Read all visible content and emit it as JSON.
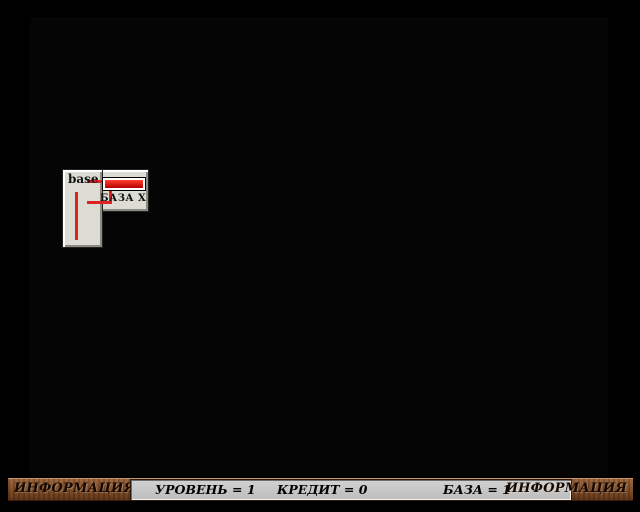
{
  "map": {
    "left": 30,
    "top": 17,
    "cols": 15,
    "rows": [
      "RRRRRRRRRRRRRRR",
      "WSSSWTTWSWTTTWF",
      "PSASSSSSSSSSSPH",
      "PSSSSBBBBBSWSSH",
      "SSSSQDDDDD2WSUH",
      "SSSSQDAAADSSSUH",
      "DGGGDDAAADSWSUH",
      "SDGDSDDDDCSWSUH",
      "SSDSSBBBBBCSSUH",
      "2DGDSSDSDSSWSUH",
      "DGGGDDSSSDSWCUH",
      "GGGGGDSZSDSWSCH"
    ],
    "width": 578,
    "height": 460,
    "legend": {
      "R": "railroad-track",
      "S": "stone-tile",
      "W": "window-wall-tile",
      "T": "window-top-tile",
      "P": "pillar-tile",
      "Q": "pillar-tile",
      "2": "window-pair-tile",
      "A": "water-tile",
      "B": "armor-plate-tile",
      "D": "red-block-tile",
      "G": "green-plate-tile",
      "C": "grate-tile",
      "U": "rubble-tile",
      "F": "ruined-red-tile",
      "H": "red-wall-tile",
      "Z": "gate-tile"
    }
  },
  "sprites": [
    {
      "type": "tank-green",
      "dir": "right",
      "x": 196,
      "y": 18
    },
    {
      "type": "tank-red",
      "dir": "right",
      "x": 378,
      "y": 15
    },
    {
      "type": "bullets-black",
      "x": 420,
      "y": 27
    },
    {
      "type": "shell-yellow",
      "x": 561,
      "y": 22
    },
    {
      "type": "tank-green",
      "dir": "right",
      "x": 110,
      "y": 58
    },
    {
      "type": "bullets-orange",
      "x": 162,
      "y": 63
    },
    {
      "type": "tank-green",
      "dir": "left",
      "x": 288,
      "y": 134
    },
    {
      "type": "bullets-orange",
      "x": 266,
      "y": 141
    },
    {
      "type": "tank-green",
      "dir": "down",
      "x": 492,
      "y": 210
    },
    {
      "type": "tank-green",
      "dir": "right",
      "x": 335,
      "y": 324
    },
    {
      "type": "bullets-orange",
      "x": 375,
      "y": 333
    },
    {
      "type": "bullets-red",
      "x": 503,
      "y": 336
    },
    {
      "type": "green-cross",
      "x": 116,
      "y": 100
    }
  ],
  "base_sign": {
    "title": "base",
    "label": "БАЗА X",
    "crosses": 3
  },
  "hud": {
    "left_icons": 3,
    "right_icons": 18,
    "icon": "tank-icon"
  },
  "status_bar": {
    "left_label": "ИНФОРМАЦИЯ",
    "level": "УРОВЕНЬ = 1",
    "credit": "КРЕДИТ = 0",
    "base": "БАЗА = 1",
    "right_label": "ИНФОРМАЦИЯ"
  },
  "colors": {
    "red_block": "#ef1414",
    "water": "#1238e8",
    "navy_plate": "#1e2c98",
    "green_tile": "#1e8c1e",
    "plate_olive": "#b09a28",
    "wood_bar": "#8a5a36",
    "panel_gray": "#c6c6c6",
    "accent_red": "#dd2222",
    "icon_blue": "#2a52e8"
  }
}
